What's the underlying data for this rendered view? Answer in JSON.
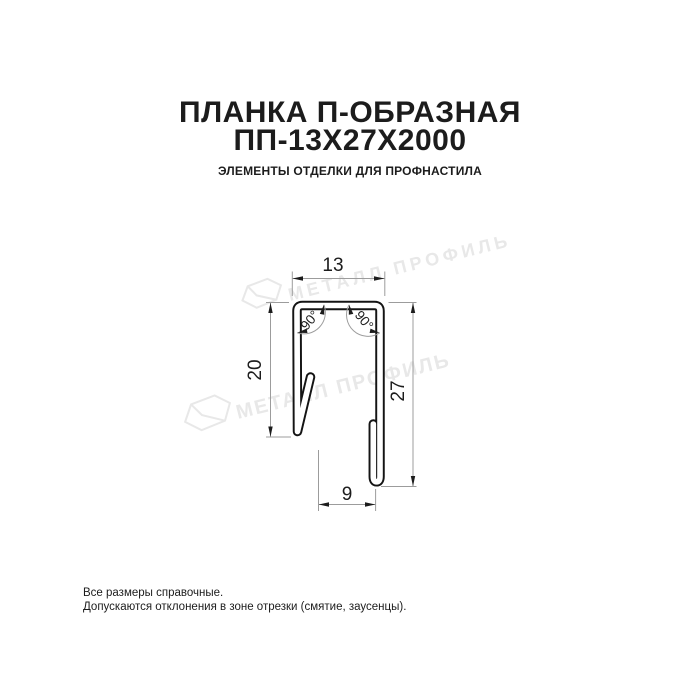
{
  "header": {
    "title_line1": "ПЛАНКА П-ОБРАЗНАЯ",
    "title_line2": "ПП-13Х27Х2000",
    "subtitle": "ЭЛЕМЕНТЫ ОТДЕЛКИ ДЛЯ ПРОФНАСТИЛА"
  },
  "drawing": {
    "dim_top_width": "13",
    "dim_left_height": "20",
    "dim_right_height": "27",
    "dim_bottom_width": "9",
    "angle_left": "90°",
    "angle_right": "90°",
    "watermark_text": "МЕТАЛЛ ПРОФИЛЬ"
  },
  "footer": {
    "line1": "Все размеры справочные.",
    "line2": "Допускаются отклонения в зоне отрезки (смятие, заусенцы)."
  },
  "colors": {
    "ink": "#1c1c1c",
    "line": "#9c9c9c",
    "profile": "#141414",
    "watermark": "#e8e8e8"
  }
}
